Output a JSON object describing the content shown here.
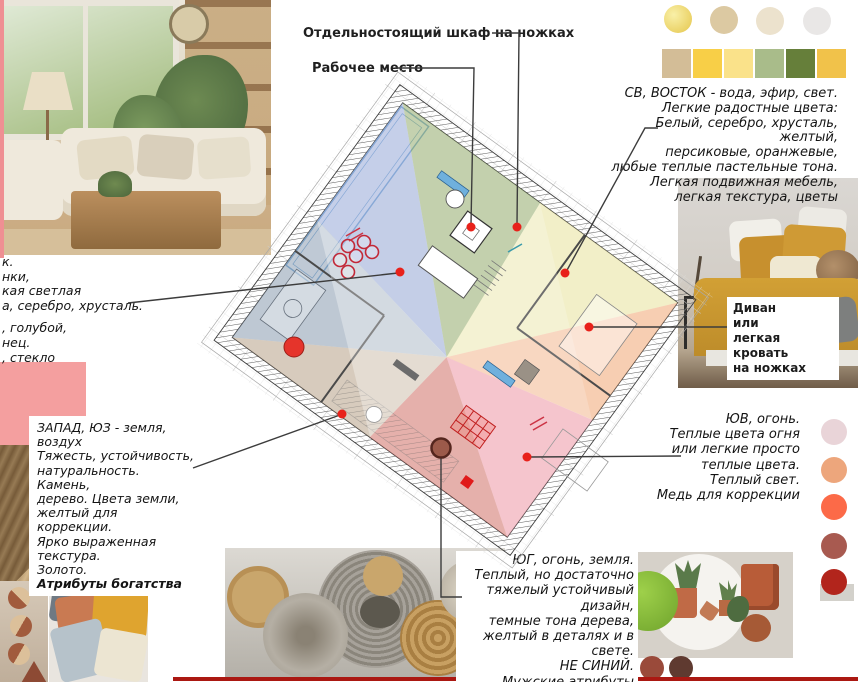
{
  "annotations": {
    "cabinet_label": "Отдельностоящий шкаф на ножках",
    "workplace_label": "Рабочее место",
    "sofa_label_lines": [
      "Диван",
      "или",
      "легкая кровать",
      "на ножках"
    ],
    "left_fragments": [
      "к.",
      "нки,",
      "кая светлая",
      "а, серебро, хрусталь.",
      ", голубой,",
      "нец.",
      ", стекло"
    ],
    "east_block": [
      "СВ, ВОСТОК - вода, эфир, свет.",
      "Легкие радостные цвета:",
      "Белый, серебро, хрусталь, желтый,",
      "персиковые, оранжевые,",
      "любые теплые пастельные тона.",
      "Легкая подвижная мебель,",
      "легкая текстура, цветы"
    ],
    "west_block": [
      "ЗАПАД, ЮЗ - земля, воздух",
      "Тяжесть, устойчивость,",
      "натуральность. Камень,",
      "дерево. Цвета земли,",
      "желтый для коррекции.",
      "Ярко выраженная текстура.",
      "Золото."
    ],
    "west_block_bold": "Атрибуты богатства",
    "se_block": [
      "ЮВ, огонь.",
      "Теплые цвета огня",
      "или легкие просто",
      "теплые цвета.",
      "Теплый свет.",
      "Медь для коррекции"
    ],
    "south_block": [
      "ЮГ, огонь, земля.",
      "Теплый, но достаточно",
      "тяжелый устойчивый дизайн,",
      "темные тона дерева,",
      "желтый в деталях и в свете.",
      "НЕ СИНИЙ.",
      "Мужские атрибуты"
    ]
  },
  "palettes": {
    "top_circles": [
      "radial-gradient(circle at 35% 35%, #f9f0a8, #e5c64c)",
      "#dcc9a2",
      "#ece2cd",
      "#e9e7e6"
    ],
    "top_squares": [
      "#d3bd97",
      "#f8cf47",
      "#fae28a",
      "#a9bc8a",
      "#667f3a",
      "#f1c24a"
    ],
    "right_circles": [
      "#e9d4d8",
      "#eda67c",
      "#fc6a48",
      "#a85a50",
      "#b2251c"
    ],
    "bottom_circles": [
      "#e5e0d6",
      "#e8a176",
      "#9a4a3a",
      "#5f3a30"
    ],
    "pink_swatch": "#f49f9f",
    "bottom_line": "#ab1812"
  },
  "plan": {
    "sector_colors": {
      "northwest_blue": "rgba(150,168,215,0.55)",
      "north_green": "rgba(148,172,110,0.55)",
      "northeast_yellow": "rgba(232,226,150,0.50)",
      "east_salmon": "rgba(242,168,118,0.55)",
      "southeast_pink": "rgba(238,152,168,0.55)",
      "south_red": "rgba(205,100,92,0.50)",
      "southwest_tan": "rgba(168,142,112,0.45)",
      "west_bluegray": "rgba(128,148,172,0.50)"
    },
    "marker_red": "#e8211a",
    "marker_big_red": "#e5342b",
    "marker_brown": "#9c5a4a"
  }
}
